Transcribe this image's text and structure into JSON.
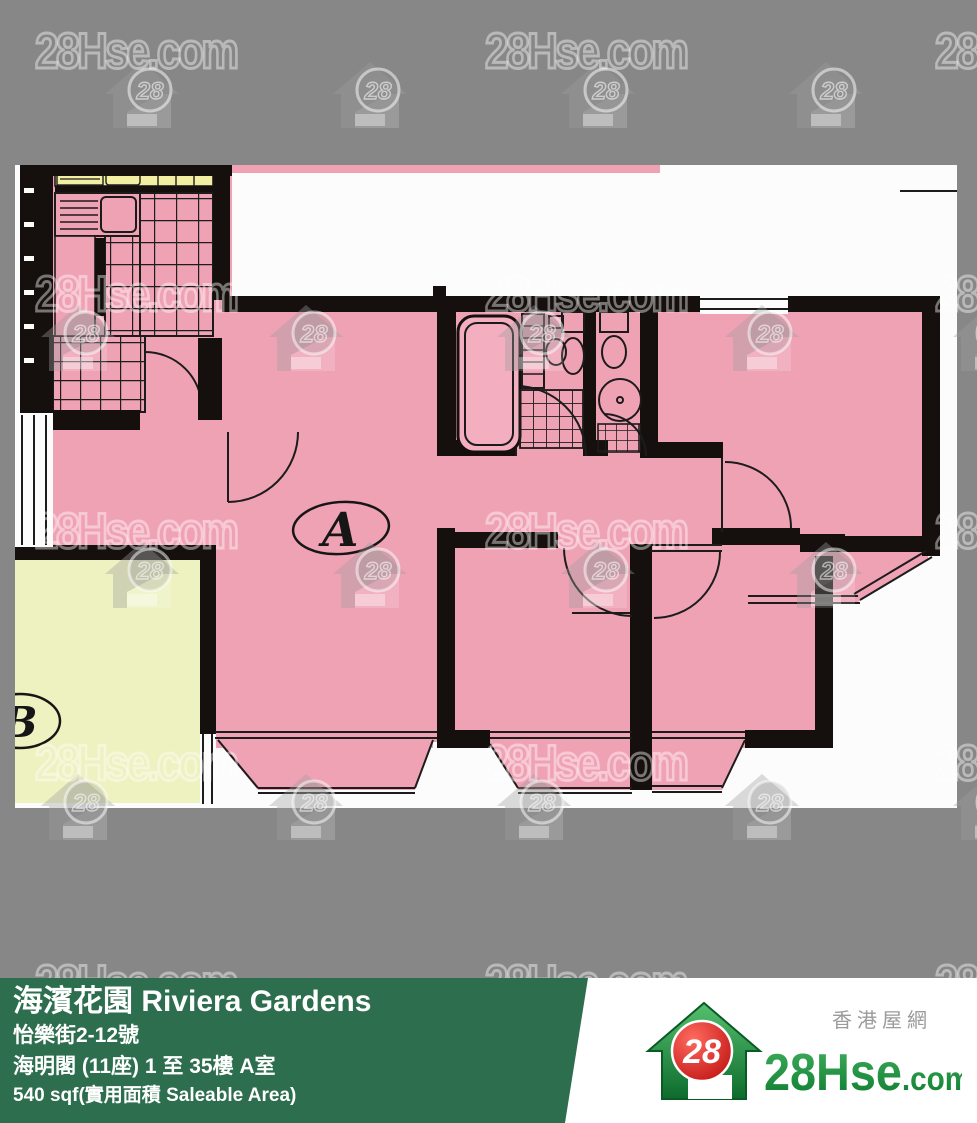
{
  "watermark": {
    "text": "28Hse.com",
    "badge": "28"
  },
  "floorplan": {
    "unit_a_label": "A",
    "unit_b_label": "B",
    "colors": {
      "room_pink": "#f0a2b5",
      "adjacent_unit_yellow": "#edf2c0",
      "counter_yellow": "#f2efa3",
      "wall_black": "#15100d",
      "page_white": "#fcfcfc",
      "background_gray": "#878787"
    }
  },
  "banner": {
    "title": "海濱花園 Riviera Gardens",
    "address": "怡樂街2-12號",
    "block_floor_flat": "海明閣 (11座) 1 至 35樓 A室",
    "area": "540 sqf(實用面積 Saleable Area)",
    "bg_color": "#2d6e4e"
  },
  "logo": {
    "site_name_zh": "香港屋網",
    "brand": "28Hse",
    "brand_suffix": ".com",
    "badge": "28",
    "brand_green": "#17913b",
    "badge_red": "#cc1111"
  }
}
